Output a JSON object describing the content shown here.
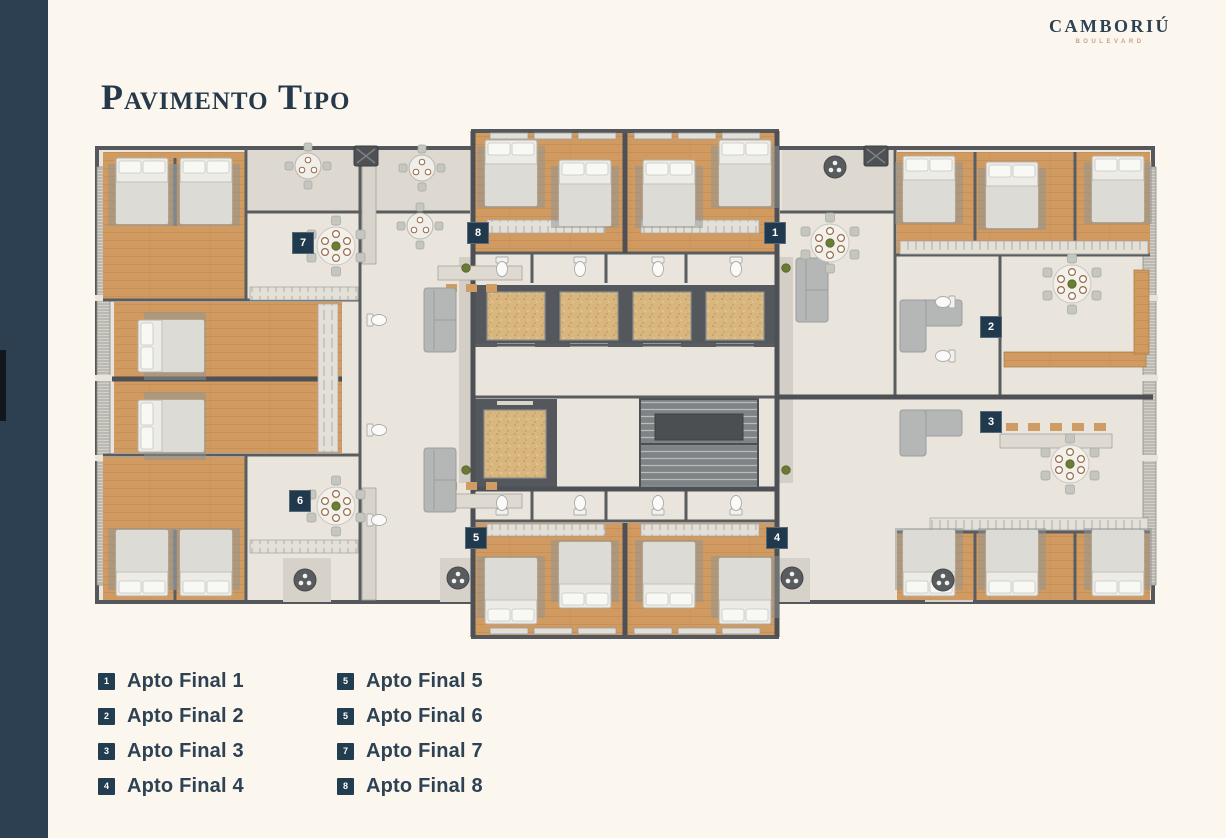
{
  "colors": {
    "background": "#fbf7ef",
    "sidebar": "#2d4051",
    "accent_navy": "#20394d",
    "title_navy": "#26394b",
    "wall_gray": "#55585b",
    "floor": "#e9e5dd",
    "wood": "#d19a60",
    "elevator_tan": "#d8b67d",
    "tagline_tan": "#c8a18c"
  },
  "header": {
    "title": "Pavimento Tipo",
    "brand": {
      "name": "CAMBORIÚ",
      "tagline": "BOULEVARD"
    }
  },
  "floor_plan": {
    "markers": [
      {
        "number": "1"
      },
      {
        "number": "2"
      },
      {
        "number": "3"
      },
      {
        "number": "4"
      },
      {
        "number": "5"
      },
      {
        "number": "6"
      },
      {
        "number": "7"
      },
      {
        "number": "8"
      }
    ]
  },
  "legend": {
    "left": [
      {
        "badge": "1",
        "label": "Apto Final 1"
      },
      {
        "badge": "2",
        "label": "Apto Final 2"
      },
      {
        "badge": "3",
        "label": "Apto Final 3"
      },
      {
        "badge": "4",
        "label": "Apto Final 4"
      }
    ],
    "right": [
      {
        "badge": "5",
        "label": "Apto Final 5"
      },
      {
        "badge": "5",
        "label": "Apto Final 6"
      },
      {
        "badge": "7",
        "label": "Apto Final 7"
      },
      {
        "badge": "8",
        "label": "Apto Final 8"
      }
    ]
  }
}
